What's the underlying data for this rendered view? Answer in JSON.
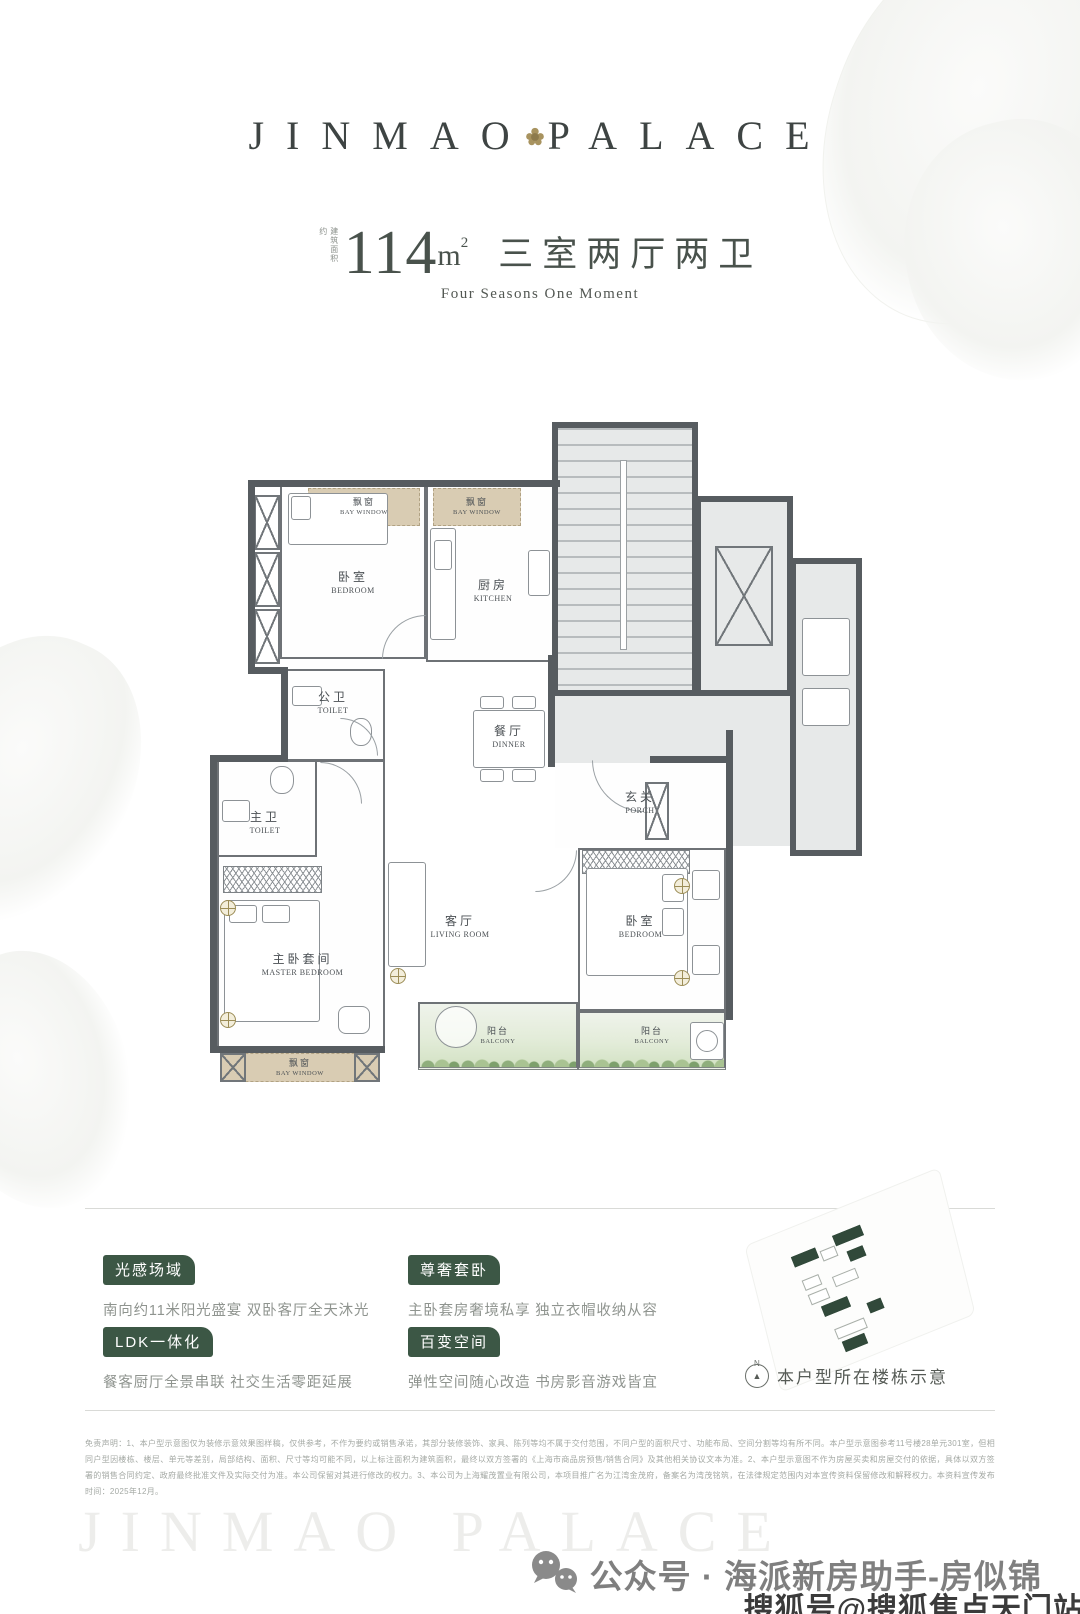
{
  "colors": {
    "accent_green": "#3c5745",
    "gold": "#a8935f",
    "wall": "#575c60",
    "bay_tan": "#d9ccb3"
  },
  "header": {
    "logo_left": "JINMAO",
    "logo_right": "PALACE",
    "area_prefix": "建筑面积约",
    "area_value": "114",
    "area_unit": "m",
    "area_sup": "2",
    "rooms_title": "三室两厅两卫",
    "tagline": "Four Seasons One Moment"
  },
  "floorplan": {
    "rooms": {
      "bay1": {
        "cn": "飘窗",
        "en": "BAY WINDOW"
      },
      "bedroom1": {
        "cn": "卧室",
        "en": "BEDROOM"
      },
      "bay2": {
        "cn": "飘窗",
        "en": "BAY WINDOW"
      },
      "kitchen": {
        "cn": "厨房",
        "en": "KITCHEN"
      },
      "toilet1": {
        "cn": "公卫",
        "en": "TOILET"
      },
      "dinner": {
        "cn": "餐厅",
        "en": "DINNER"
      },
      "porch": {
        "cn": "玄关",
        "en": "PORCH"
      },
      "toilet2": {
        "cn": "主卫",
        "en": "TOILET"
      },
      "master": {
        "cn": "主卧套间",
        "en": "MASTER BEDROOM"
      },
      "living": {
        "cn": "客厅",
        "en": "LIVING ROOM"
      },
      "bedroom2": {
        "cn": "卧室",
        "en": "BEDROOM"
      },
      "balcony1": {
        "cn": "阳台",
        "en": "BALCONY"
      },
      "balcony2": {
        "cn": "阳台",
        "en": "BALCONY"
      },
      "bay3": {
        "cn": "飘窗",
        "en": "BAY WINDOW"
      }
    }
  },
  "features": [
    {
      "label": "光感场域",
      "desc": "南向约11米阳光盛宴 双卧客厅全天沐光"
    },
    {
      "label": "尊奢套卧",
      "desc": "主卧套房奢境私享 独立衣帽收纳从容"
    },
    {
      "label": "LDK一体化",
      "desc": "餐客厨厅全景串联 社交生活零距延展"
    },
    {
      "label": "百变空间",
      "desc": "弹性空间随心改造 书房影音游戏皆宜"
    }
  ],
  "siteplan": {
    "compass_n": "N",
    "caption": "本户型所在楼栋示意"
  },
  "disclaimer": "免责声明：1、本户型示意图仅为装修示意效果图样稿，仅供参考，不作为要约或销售承诺，其部分装修装饰、家具、陈列等均不属于交付范围，不同户型的面积尺寸、功能布局、空间分割等均有所不同。本户型示意图参考11号楼28单元301室，但相同户型因楼栋、楼层、单元等差别，局部结构、面积、尺寸等均可能不同，以上标注面积为建筑面积，最终以双方签署的《上海市商品房预售/销售合同》及其他相关协议文本为准。2、本户型示意图不作为房屋买卖和房屋交付的依据，具体以双方签署的销售合同约定、政府最终批准文件及实际交付为准。本公司保留对其进行修改的权力。3、本公司为上海耀茂置业有限公司，本项目推广名为江湾金茂府，备案名为湾茂铭筑，在法律规定范围内对本宣传资料保留修改和解释权力。本资料宣传发布时间：2025年12月。",
  "footer": {
    "watermark": "JINMAO PALACE",
    "wechat_label": "公众号 · 海派新房助手-房似锦",
    "sohu_label": "搜狐号@搜狐焦点天门站"
  }
}
